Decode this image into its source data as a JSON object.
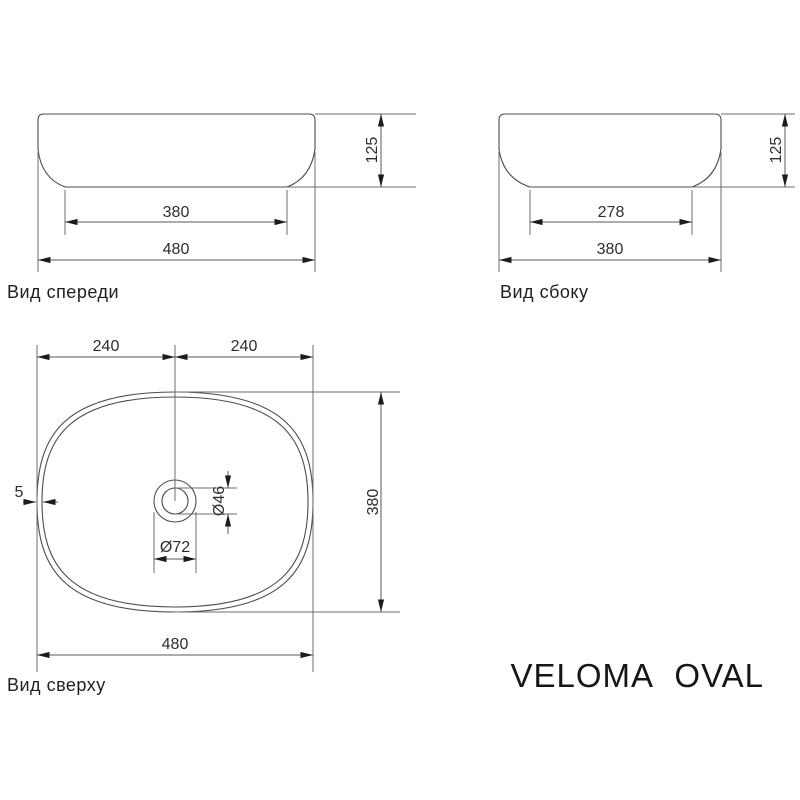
{
  "title": "VELOMA OVAL",
  "views": {
    "front": {
      "label": "Вид спереди",
      "inner_width": "380",
      "outer_width": "480",
      "height": "125"
    },
    "side": {
      "label": "Вид сбоку",
      "inner_width": "278",
      "outer_width": "380",
      "height": "125"
    },
    "top": {
      "label": "Вид сверху",
      "half_left": "240",
      "half_right": "240",
      "depth": "380",
      "width": "480",
      "wall_thickness": "5",
      "drain_inner_dia": "Ø46",
      "drain_outer_dia": "Ø72"
    }
  }
}
